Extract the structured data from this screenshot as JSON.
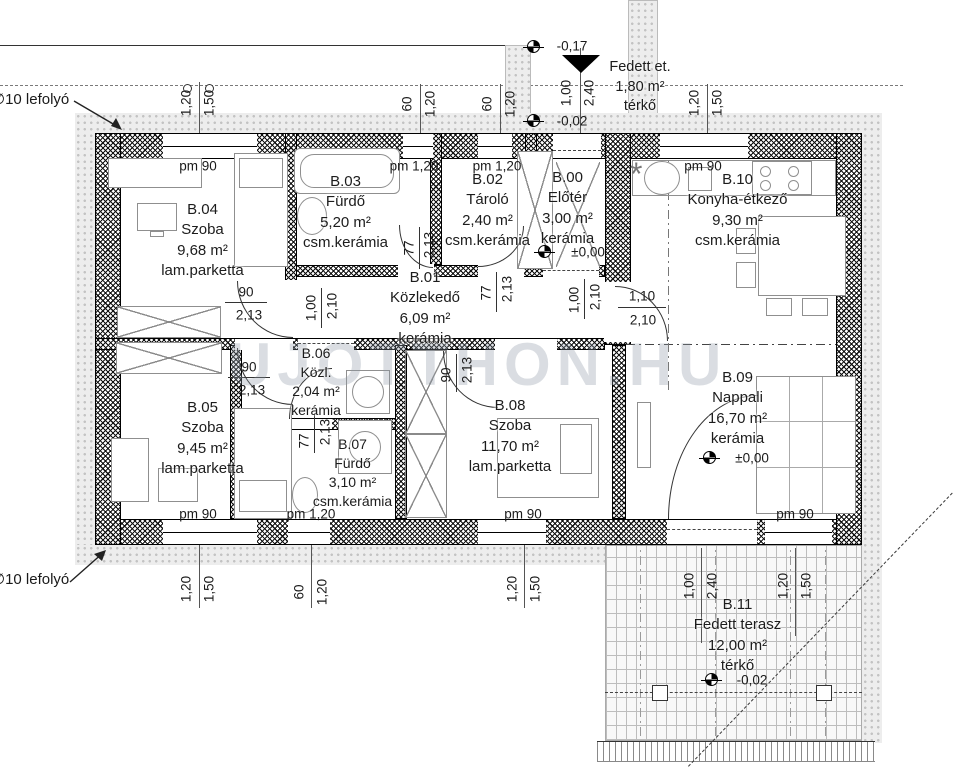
{
  "watermark": "UJOTTHON.HU",
  "drain_label_top": "∅10 lefolyó",
  "drain_label_bottom": "∅10 lefolyó",
  "entry": {
    "l1": "Fedett et.",
    "l2": "1,80 m²",
    "l3": "térkő"
  },
  "symbols": {
    "boiler": "*"
  },
  "colors": {
    "wall": "#000000",
    "insulation": "#ededed",
    "label": "#1c1c1c",
    "watermark": "#8d99a6"
  },
  "rooms": [
    {
      "id": "B.04",
      "name": "Szoba",
      "area": "9,68 m²",
      "floor": "lam.parketta"
    },
    {
      "id": "B.03",
      "name": "Fürdő",
      "area": "5,20 m²",
      "floor": "csm.kerámia"
    },
    {
      "id": "B.02",
      "name": "Tároló",
      "area": "2,40 m²",
      "floor": "csm.kerámia"
    },
    {
      "id": "B.00",
      "name": "Előtér",
      "area": "3,00 m²",
      "floor": "kerámia",
      "level": "±0,00"
    },
    {
      "id": "B.10",
      "name": "Konyha-étkező",
      "area": "9,30 m²",
      "floor": "csm.kerámia"
    },
    {
      "id": "B.01",
      "name": "Közlekedő",
      "area": "6,09 m²",
      "floor": "kerámia"
    },
    {
      "id": "B.06",
      "name": "Közl.",
      "area": "2,04 m²",
      "floor": "kerámia"
    },
    {
      "id": "B.05",
      "name": "Szoba",
      "area": "9,45 m²",
      "floor": "lam.parketta"
    },
    {
      "id": "B.07",
      "name": "Fürdő",
      "area": "3,10 m²",
      "floor": "csm.kerámia"
    },
    {
      "id": "B.08",
      "name": "Szoba",
      "area": "11,70 m²",
      "floor": "lam.parketta"
    },
    {
      "id": "B.09",
      "name": "Nappali",
      "area": "16,70 m²",
      "floor": "kerámia",
      "level": "±0,00"
    },
    {
      "id": "B.11",
      "name": "Fedett terasz",
      "area": "12,00 m²",
      "floor": "térkő",
      "level": "-0,02"
    }
  ],
  "dl": [
    "1,20",
    "1,50",
    "60",
    "1,20",
    "60",
    "1,20",
    "1,00",
    "2,40",
    "1,20",
    "1,50",
    "1,20",
    "1,50",
    "60",
    "1,20",
    "1,20",
    "1,50",
    "1,00",
    "2,40",
    "1,20",
    "1,50",
    "pm 90",
    "pm 1,20",
    "pm 1,20",
    "pm 90",
    "pm 90",
    "pm 1,20",
    "pm 90",
    "pm 90",
    "90",
    "2,13",
    "90",
    "2,13",
    "1,10",
    "2,10",
    "1,00",
    "2,10",
    "77",
    "2,13",
    "77",
    "2,13",
    "1,00",
    "2,10",
    "90",
    "2,13",
    "77",
    "2,13",
    "-0,17",
    "-0,02"
  ]
}
